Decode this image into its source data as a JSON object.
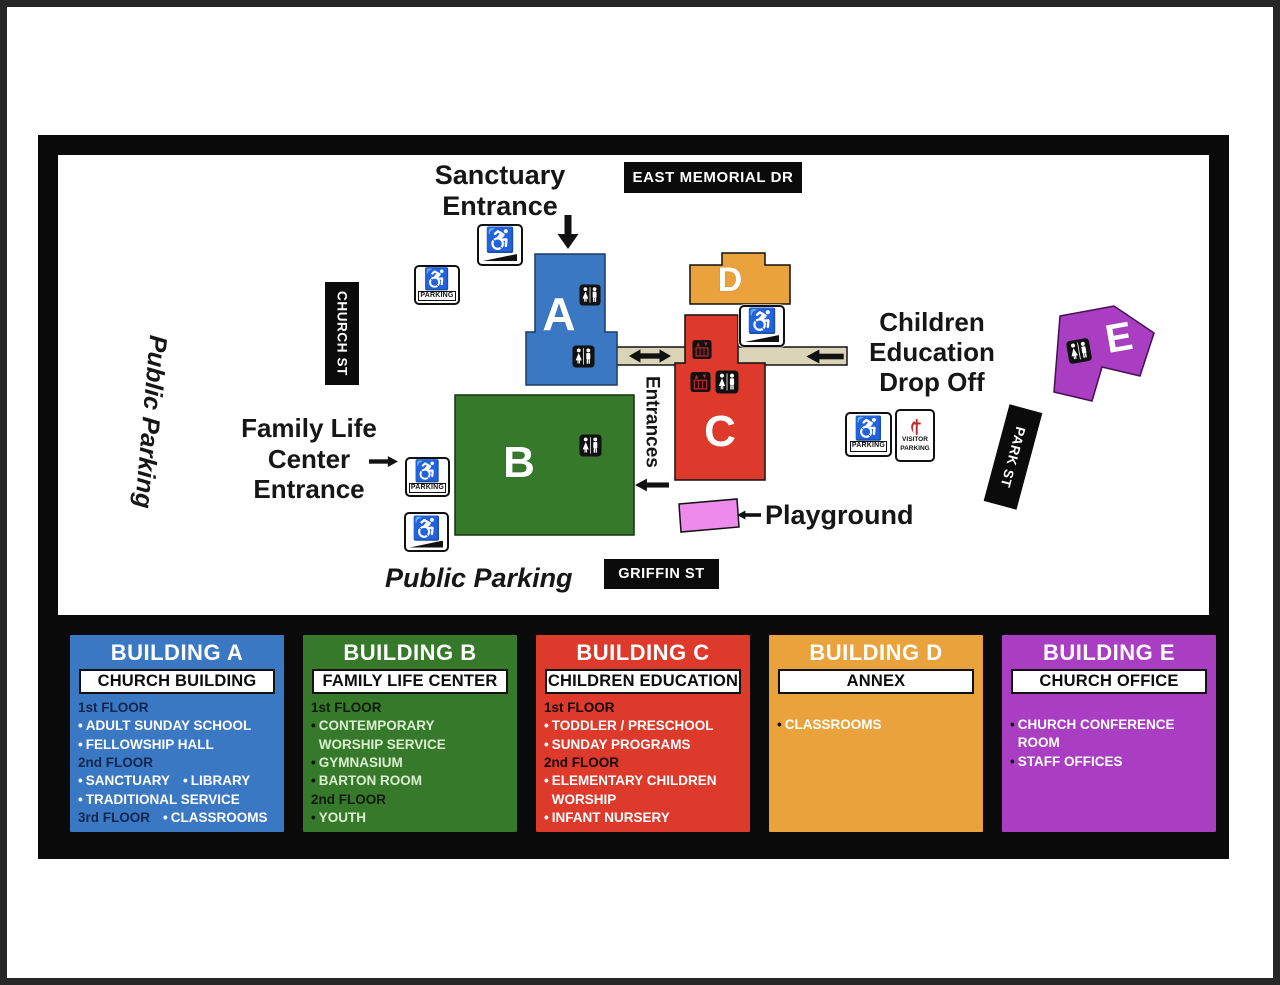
{
  "colors": {
    "building_a_blue": "#3B78C3",
    "building_b_green": "#37792B",
    "building_c_red": "#DE3A2C",
    "building_d_orange": "#E9A23C",
    "building_e_purple": "#A93EC3",
    "playground_pink": "#EE8BEA",
    "corridor_tan": "#DCD4B6",
    "street_black": "#0B0B0B",
    "umc_red": "#C1272D"
  },
  "map": {
    "streets": {
      "east_memorial": "EAST MEMORIAL DR",
      "church": "CHURCH ST",
      "griffin": "GRIFFIN ST",
      "park": "PARK ST"
    },
    "labels": {
      "sanctuary_line1": "Sanctuary",
      "sanctuary_line2": "Entrance",
      "public_parking_left": "Public Parking",
      "public_parking_bottom": "Public Parking",
      "flc_line1": "Family Life",
      "flc_line2": "Center",
      "flc_line3": "Entrance",
      "children_line1": "Children",
      "children_line2": "Education",
      "children_line3": "Drop Off",
      "playground": "Playground",
      "entrances": "Entrances"
    },
    "buildings": {
      "A": {
        "letter": "A"
      },
      "B": {
        "letter": "B"
      },
      "C": {
        "letter": "C"
      },
      "D": {
        "letter": "D"
      },
      "E": {
        "letter": "E"
      }
    },
    "icons": {
      "parking_label": "PARKING",
      "visitor_line1": "VISITOR",
      "visitor_line2": "PARKING"
    }
  },
  "legend": {
    "panels": [
      {
        "id": "a",
        "title": "BUILDING A",
        "subtitle": "CHURCH BUILDING",
        "color": "#3B78C3",
        "floor_color": "#12264E",
        "item_color": "#FFFFFF",
        "bullet_color": "#FFFFFF",
        "lines": [
          [
            {
              "floor": "1st FLOOR"
            }
          ],
          [
            {
              "bullet": "ADULT SUNDAY SCHOOL"
            }
          ],
          [
            {
              "bullet": "FELLOWSHIP HALL"
            }
          ],
          [
            {
              "floor": "2nd FLOOR"
            }
          ],
          [
            {
              "bullet": "SANCTUARY"
            },
            {
              "bullet": "LIBRARY"
            }
          ],
          [
            {
              "bullet": "TRADITIONAL SERVICE"
            }
          ],
          [
            {
              "floor": "3rd FLOOR"
            },
            {
              "bullet": "CLASSROOMS"
            }
          ]
        ]
      },
      {
        "id": "b",
        "title": "BUILDING B",
        "subtitle": "FAMILY LIFE CENTER",
        "color": "#37792B",
        "floor_color": "#0E1B0B",
        "item_color": "#D9EFCF",
        "bullet_color": "#111111",
        "lines": [
          [
            {
              "floor": "1st FLOOR"
            }
          ],
          [
            {
              "bullet": "CONTEMPORARY\nWORSHIP SERVICE"
            }
          ],
          [
            {
              "bullet": "GYMNASIUM"
            }
          ],
          [
            {
              "bullet": "BARTON ROOM"
            }
          ],
          [
            {
              "floor": "2nd FLOOR"
            }
          ],
          [
            {
              "bullet": "YOUTH"
            }
          ]
        ]
      },
      {
        "id": "c",
        "title": "BUILDING C",
        "subtitle": "CHILDREN EDUCATION",
        "color": "#DE3A2C",
        "floor_color": "#160505",
        "item_color": "#FFFFFF",
        "bullet_color": "#FFFFFF",
        "lines": [
          [
            {
              "floor": "1st FLOOR"
            }
          ],
          [
            {
              "bullet": "TODDLER / PRESCHOOL"
            }
          ],
          [
            {
              "bullet": "SUNDAY PROGRAMS"
            }
          ],
          [
            {
              "floor": "2nd FLOOR"
            }
          ],
          [
            {
              "bullet": "ELEMENTARY CHILDREN\nWORSHIP"
            }
          ],
          [
            {
              "bullet": "INFANT NURSERY"
            }
          ]
        ]
      },
      {
        "id": "d",
        "title": "BUILDING D",
        "subtitle": "ANNEX",
        "color": "#E9A23C",
        "floor_color": "#111111",
        "item_color": "#FFFFFF",
        "bullet_color": "#111111",
        "items_offset": 20,
        "lines": [
          [
            {
              "bullet": "CLASSROOMS"
            }
          ]
        ]
      },
      {
        "id": "e",
        "title": "BUILDING E",
        "subtitle": "CHURCH OFFICE",
        "color": "#A93EC3",
        "floor_color": "#111111",
        "item_color": "#FFFFFF",
        "bullet_color": "#111111",
        "items_offset": 20,
        "lines": [
          [
            {
              "bullet": "CHURCH CONFERENCE\nROOM"
            }
          ],
          [
            {
              "bullet": "STAFF OFFICES"
            }
          ]
        ]
      }
    ]
  }
}
